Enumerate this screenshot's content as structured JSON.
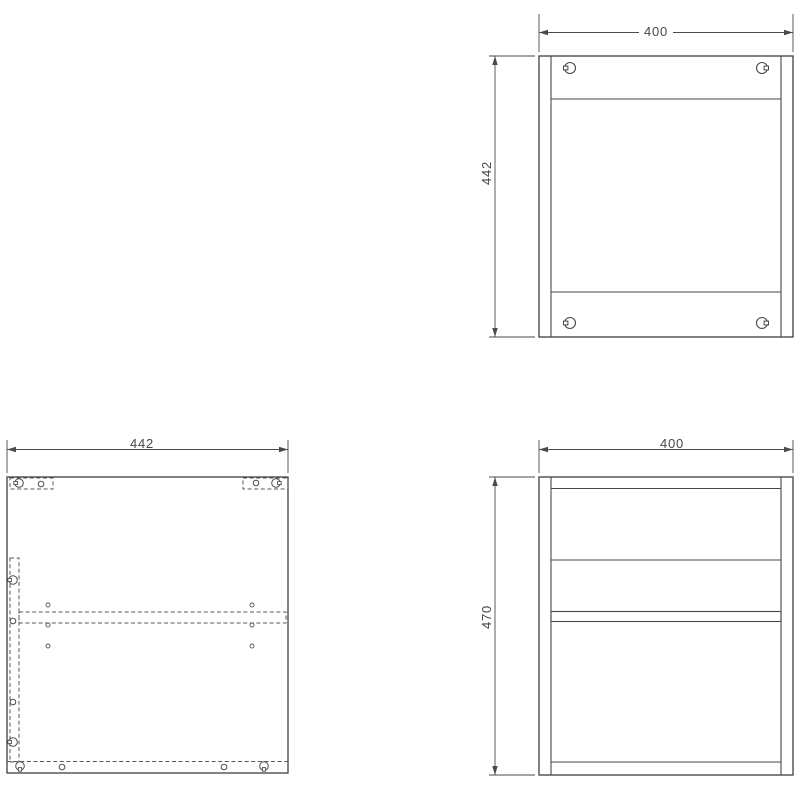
{
  "document": {
    "type": "furniture-technical-drawing",
    "background": "#ffffff"
  },
  "colors": {
    "solid_line": "#474747",
    "hidden_dashed_line": "#585858",
    "dimension_line": "#4a4a4a",
    "dimension_text": "#474747"
  },
  "icons": {
    "cam_lock": "circle-with-side-slot",
    "drill_hole": "small-open-circle",
    "dowel_hole": "tiny-open-circle"
  },
  "views": {
    "top": {
      "label": "top view",
      "width_dim": "400",
      "depth_dim": "442"
    },
    "side": {
      "label": "side panel view",
      "width_dim": "442"
    },
    "front": {
      "label": "front view",
      "width_dim": "400",
      "height_dim": "470"
    }
  }
}
